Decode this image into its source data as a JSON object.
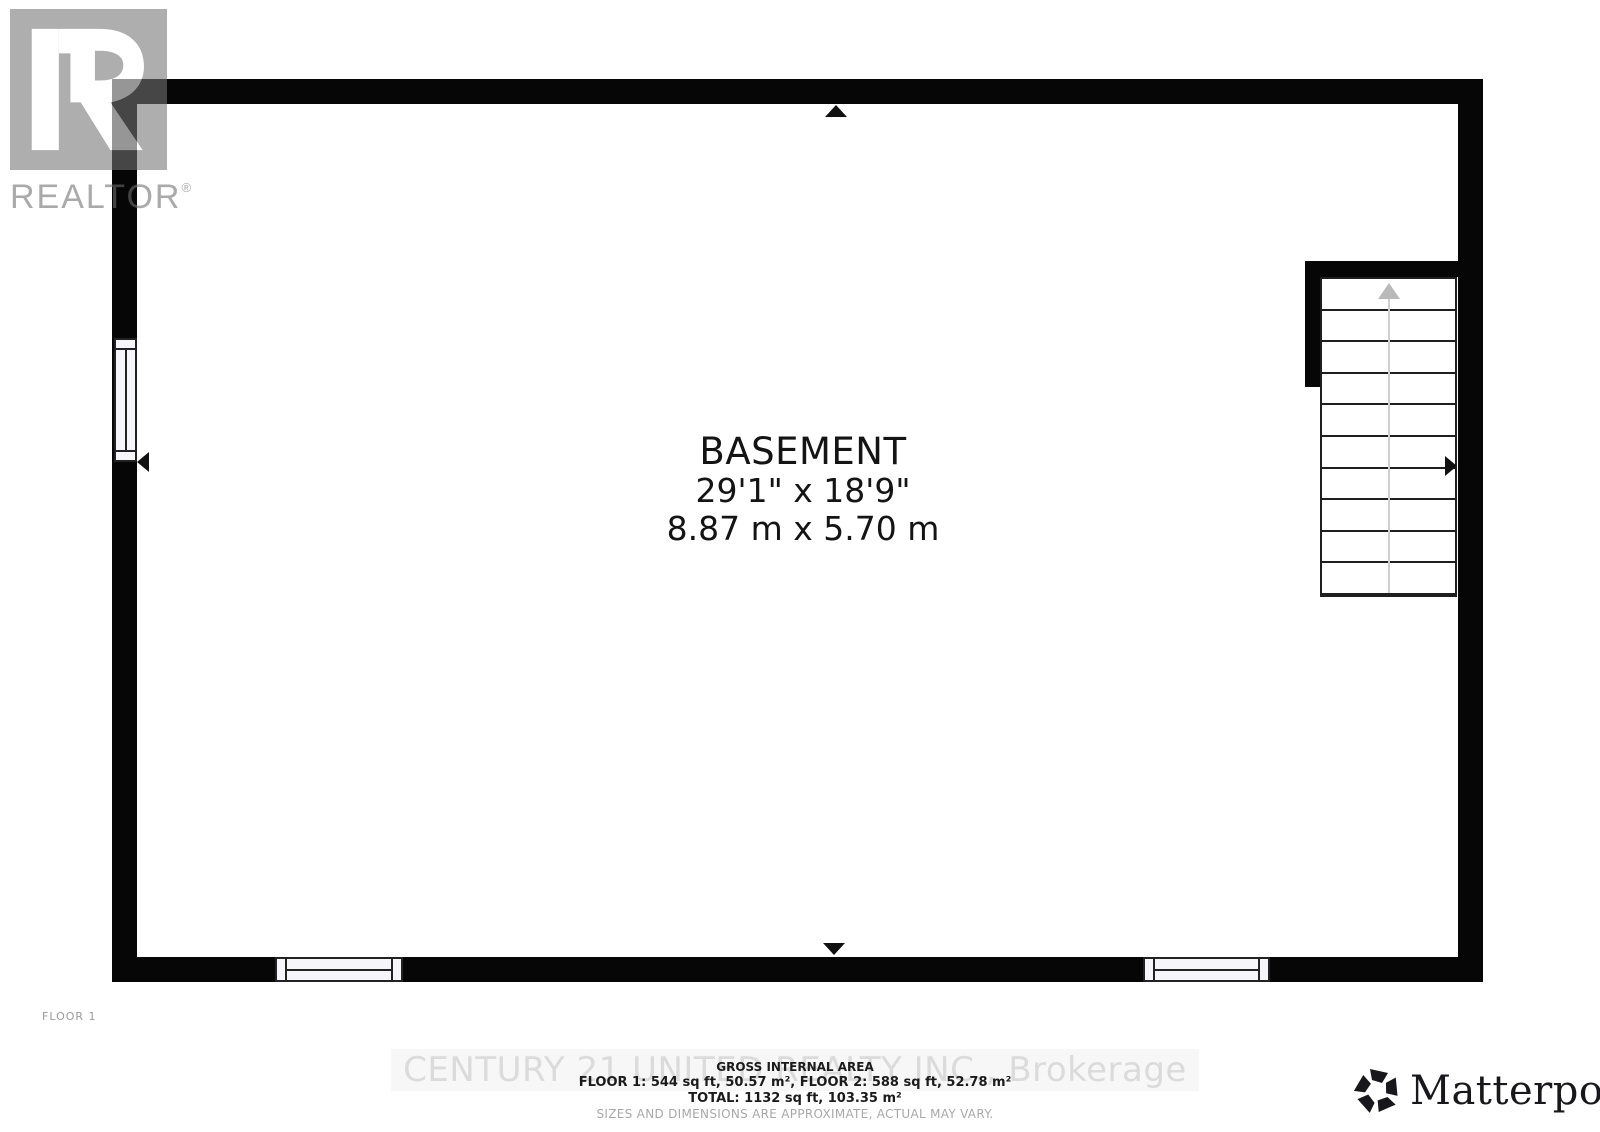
{
  "branding": {
    "realtor": {
      "label": "REALTOR",
      "reg": "®"
    },
    "matterport": {
      "label": "Matterport",
      "reg": "®"
    }
  },
  "plan": {
    "floor_label": "FLOOR 1",
    "room": {
      "name": "BASEMENT",
      "size_imperial": "29'1\" x 18'9\"",
      "size_metric": "8.87 m x 5.70 m"
    },
    "stairs": {
      "direction": "up",
      "treads": 10
    }
  },
  "footer": {
    "watermark": "CENTURY 21 UNITED REALTY INC., Brokerage",
    "gross_area_title": "GROSS INTERNAL AREA",
    "floors_line": "FLOOR 1: 544 sq ft, 50.57 m², FLOOR 2: 588 sq ft, 52.78 m²",
    "total_line": "TOTAL: 1132 sq ft, 103.35 m²",
    "disclaimer": "SIZES AND DIMENSIONS ARE APPROXIMATE, ACTUAL MAY VARY."
  },
  "colors": {
    "wall": "#060606",
    "stair_arrow_gray": "#b9b9b9",
    "watermark_gray": "#dbdbdb",
    "logo_gray": "#757575"
  }
}
